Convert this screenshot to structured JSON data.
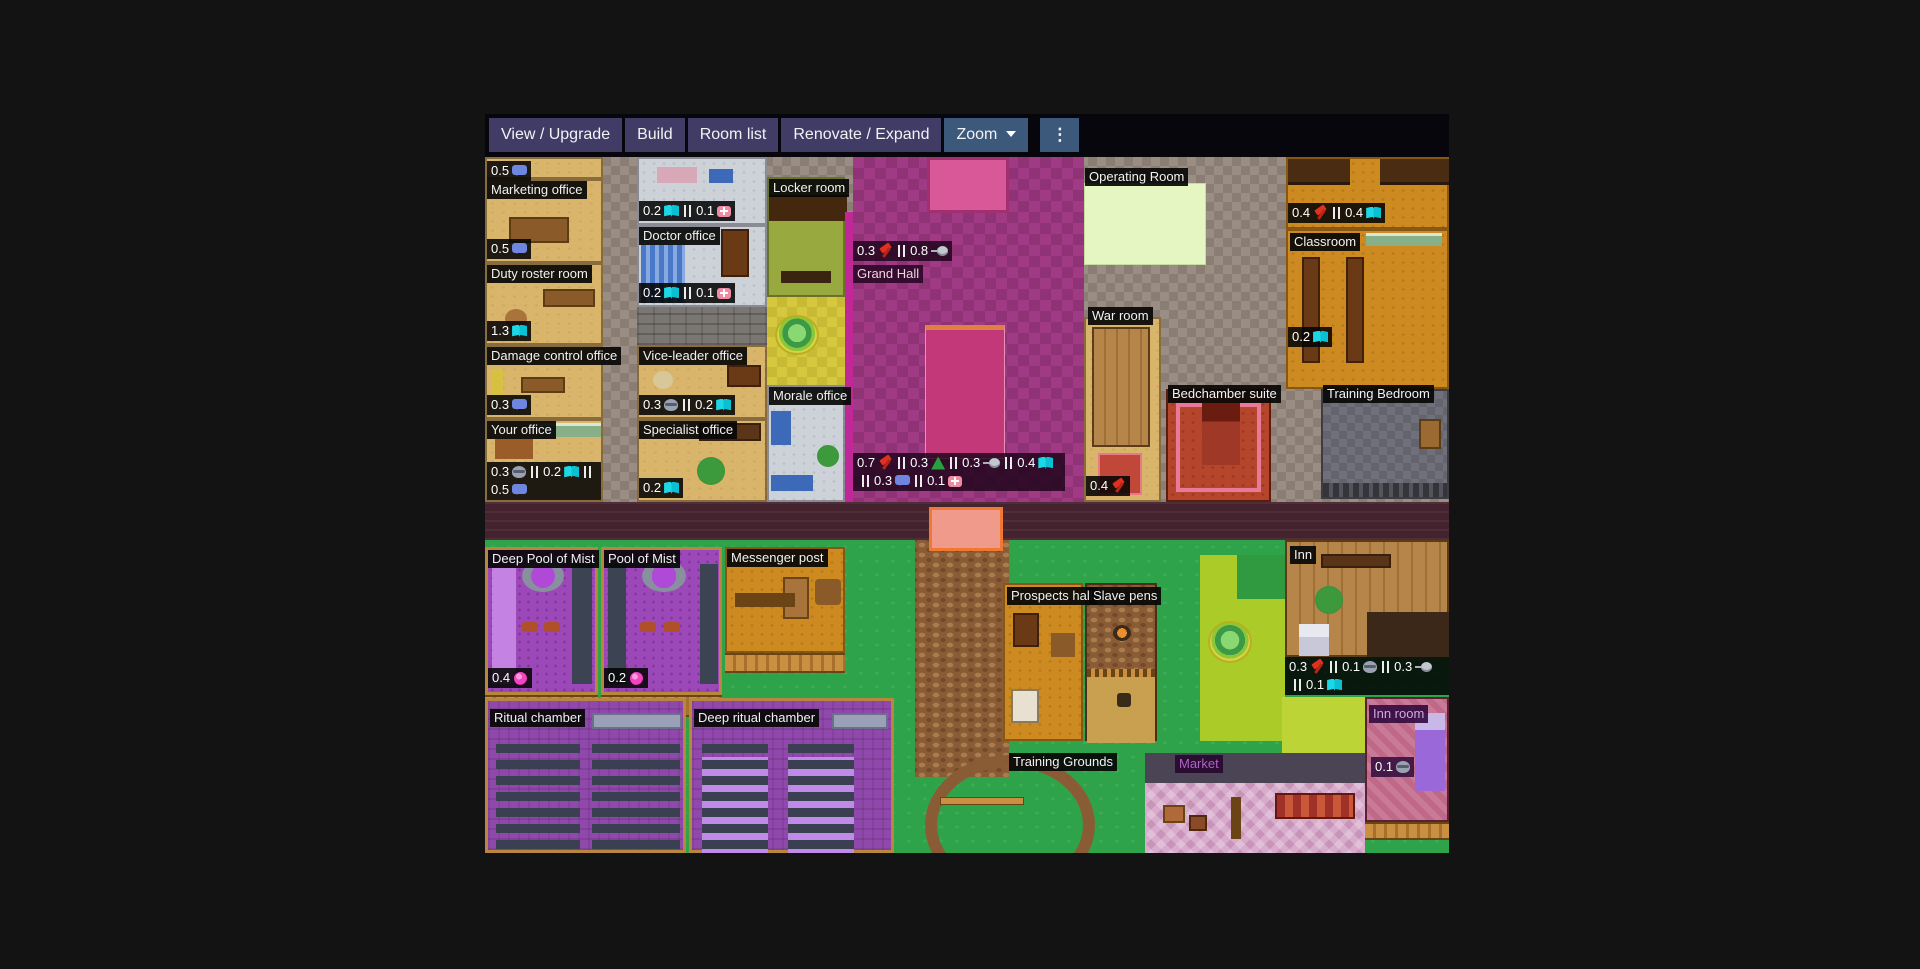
{
  "toolbar": {
    "view_upgrade": "View / Upgrade",
    "build": "Build",
    "room_list": "Room list",
    "renovate_expand": "Renovate / Expand",
    "zoom": "Zoom",
    "menu": "⋮",
    "button_color": "#413c66",
    "active_button_color": "#3c587a"
  },
  "colors": {
    "page_background": "#131313",
    "grass": "#2fa34a",
    "grand_hall": "#a13a84",
    "corridor": "#998d84",
    "stat_icon_book": "#1cd8e6",
    "stat_icon_hammer": "#e03020",
    "stat_icon_mist": "#f046c0"
  },
  "rooms": {
    "office_sliver": {
      "stats": [
        {
          "value": "0.5",
          "icon": "bubble"
        }
      ]
    },
    "marketing_office": {
      "label": "Marketing office",
      "stats": [
        {
          "value": "0.5",
          "icon": "bubble"
        }
      ]
    },
    "duty_roster_room": {
      "label": "Duty roster room",
      "stats": [
        {
          "value": "1.3",
          "icon": "book"
        }
      ]
    },
    "damage_control_office": {
      "label": "Damage control office",
      "stats": [
        {
          "value": "0.3",
          "icon": "bubble"
        }
      ]
    },
    "your_office": {
      "label": "Your office",
      "stats": [
        {
          "value": "0.3",
          "icon": "mask"
        },
        {
          "value": "0.2",
          "icon": "book"
        },
        {
          "value": "0.5",
          "icon": "bubble"
        }
      ]
    },
    "infirmary": {
      "stats": [
        {
          "value": "0.2",
          "icon": "book"
        },
        {
          "value": "0.1",
          "icon": "medkit"
        }
      ]
    },
    "doctor_office": {
      "label": "Doctor office",
      "stats": [
        {
          "value": "0.2",
          "icon": "book"
        },
        {
          "value": "0.1",
          "icon": "medkit"
        }
      ]
    },
    "vice_leader_office": {
      "label": "Vice-leader office",
      "stats": [
        {
          "value": "0.3",
          "icon": "mask"
        },
        {
          "value": "0.2",
          "icon": "book"
        }
      ]
    },
    "specialist_office": {
      "label": "Specialist office",
      "stats": [
        {
          "value": "0.2",
          "icon": "book"
        }
      ]
    },
    "locker_room": {
      "label": "Locker room"
    },
    "morale_office": {
      "label": "Morale office"
    },
    "grand_hall": {
      "label": "Grand Hall",
      "stats_top": [
        {
          "value": "0.3",
          "icon": "hammer"
        },
        {
          "value": "0.8",
          "icon": "pan"
        }
      ],
      "stats": [
        {
          "value": "0.7",
          "icon": "hammer"
        },
        {
          "value": "0.3",
          "icon": "tent"
        },
        {
          "value": "0.3",
          "icon": "pan"
        },
        {
          "value": "0.4",
          "icon": "book"
        },
        {
          "value": "0.3",
          "icon": "bubble"
        },
        {
          "value": "0.1",
          "icon": "medkit"
        }
      ]
    },
    "operating_room": {
      "label": "Operating Room"
    },
    "library": {
      "stats": [
        {
          "value": "0.4",
          "icon": "hammer"
        },
        {
          "value": "0.4",
          "icon": "book"
        }
      ]
    },
    "classroom": {
      "label": "Classroom",
      "stats": [
        {
          "value": "0.2",
          "icon": "book"
        }
      ]
    },
    "war_room": {
      "label": "War room",
      "stats": [
        {
          "value": "0.4",
          "icon": "hammer"
        }
      ]
    },
    "bedchamber_suite": {
      "label": "Bedchamber suite"
    },
    "training_bedroom": {
      "label": "Training Bedroom"
    },
    "deep_pool_of_mist": {
      "label": "Deep Pool of Mist",
      "stats": [
        {
          "value": "0.4",
          "icon": "mist"
        }
      ]
    },
    "pool_of_mist": {
      "label": "Pool of Mist",
      "stats": [
        {
          "value": "0.2",
          "icon": "mist"
        }
      ]
    },
    "messenger_post": {
      "label": "Messenger post"
    },
    "prospects_hall": {
      "label": "Prospects hall"
    },
    "slave_pens": {
      "label": "Slave pens"
    },
    "inn": {
      "label": "Inn",
      "stats": [
        {
          "value": "0.3",
          "icon": "hammer"
        },
        {
          "value": "0.1",
          "icon": "mask"
        },
        {
          "value": "0.3",
          "icon": "pan"
        },
        {
          "value": "0.1",
          "icon": "book"
        }
      ]
    },
    "inn_room": {
      "label": "Inn room",
      "stats": [
        {
          "value": "0.1",
          "icon": "mask"
        }
      ]
    },
    "ritual_chamber": {
      "label": "Ritual chamber"
    },
    "deep_ritual_chamber": {
      "label": "Deep ritual chamber"
    },
    "training_grounds": {
      "label": "Training Grounds"
    },
    "market": {
      "label": "Market"
    }
  }
}
